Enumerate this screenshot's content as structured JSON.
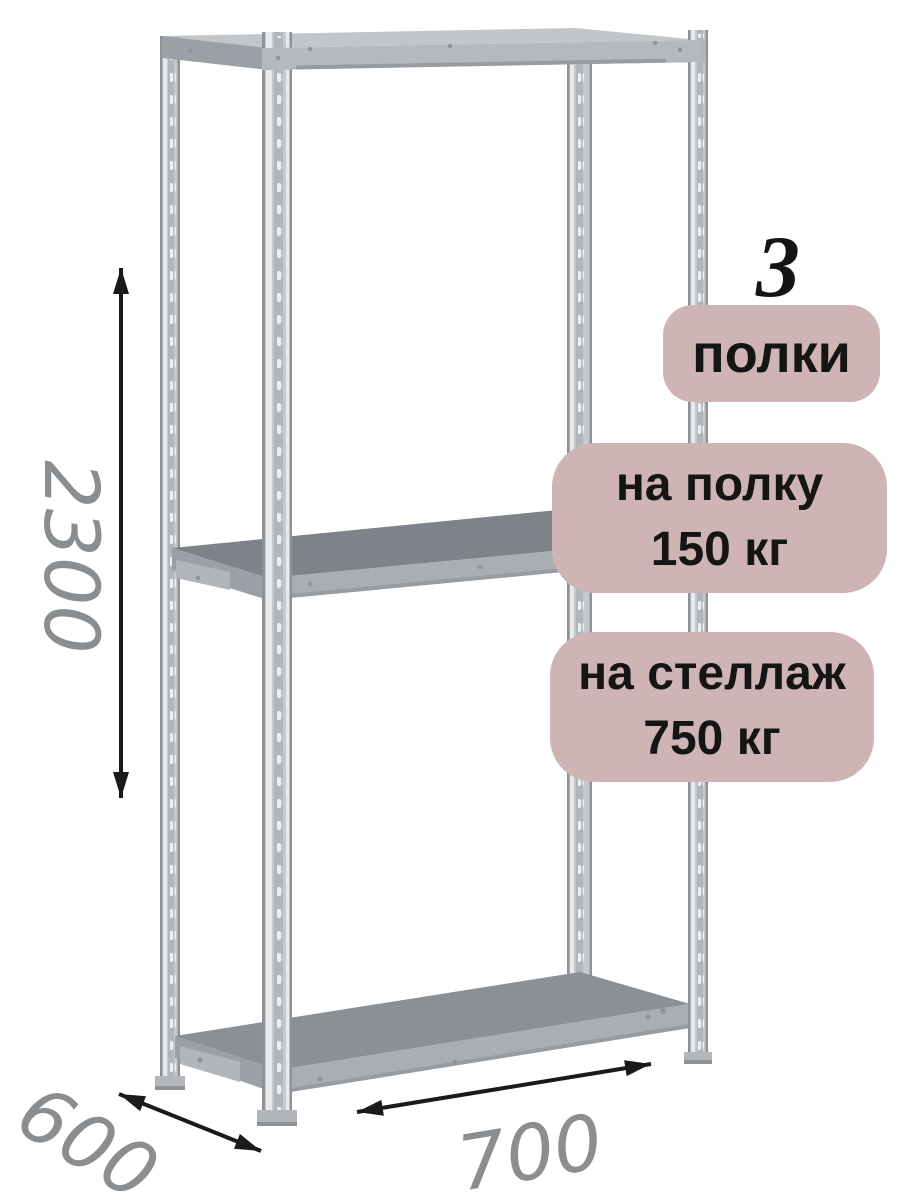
{
  "annotations": {
    "shelf_count": {
      "number": "3",
      "label": "полки"
    },
    "shelf_load": {
      "line1": "на полку",
      "line2": "150 кг"
    },
    "rack_load": {
      "line1": "на стеллаж",
      "line2": "750 кг"
    }
  },
  "dimensions": {
    "height": "2300",
    "depth": "600",
    "width": "700"
  },
  "colors": {
    "badge_bg": "#cfb4b6",
    "badge_text": "#151515",
    "dimension_text": "#8b8e90",
    "arrow": "#1a1a1a",
    "metal_base": "#c6c9cc",
    "metal_edge": "#8e9296",
    "metal_highlight": "#e7e9ea",
    "metal_mid": "#b2b6ba",
    "metal_top_face": "#c2c6c9",
    "beam": "#b4b9bd",
    "shelf_mid_top": "#7e838a",
    "shelf_bottom_top": "#8b9095",
    "fascia": "#a9aeb3",
    "side_face": "#9aa0a5",
    "edge_dark": "#979ca1"
  }
}
